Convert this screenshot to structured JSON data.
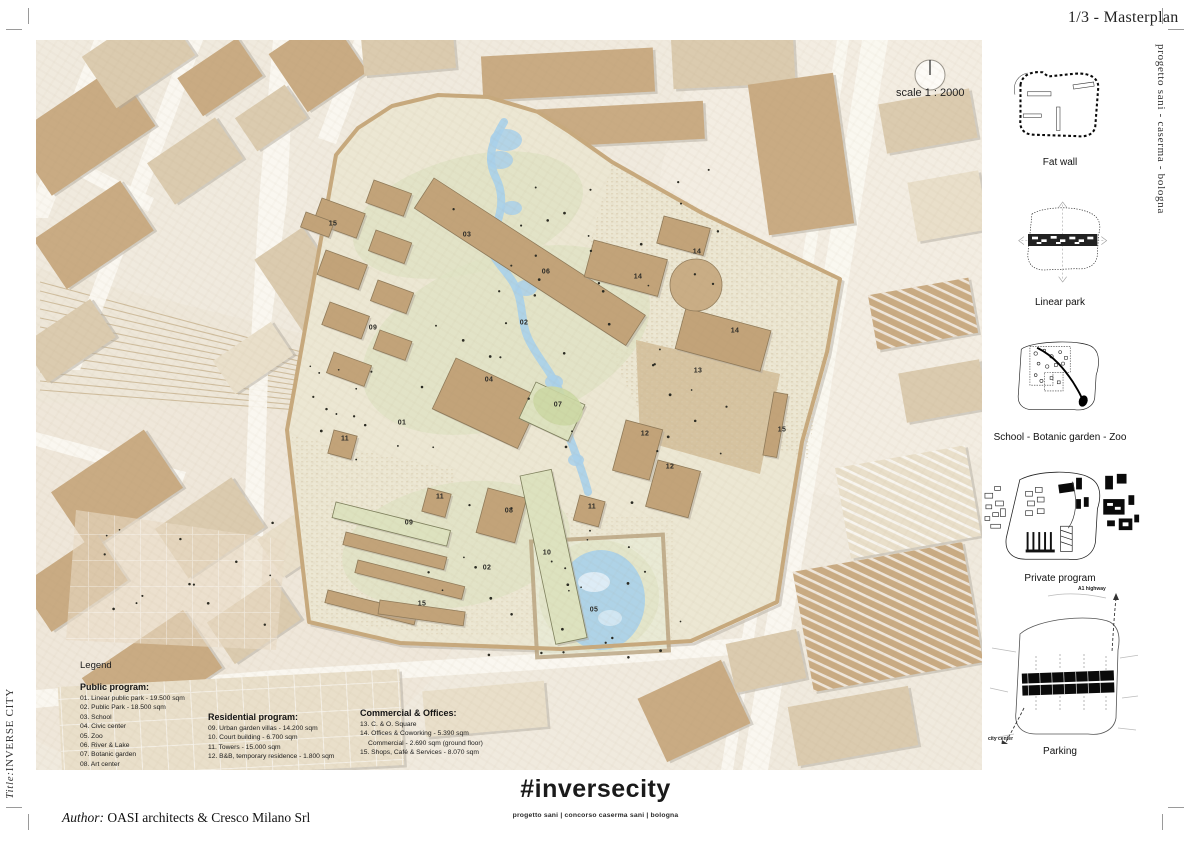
{
  "sheet": {
    "title": "1/3 - Masterplan",
    "side_text_right": "progetto sani - caserma - bologna",
    "side_text_left_label": "Title:",
    "side_text_left_value": "INVERSE CITY",
    "scale_label": "scale 1 : 2000",
    "project_title": "#inversecity",
    "footer_tags": "progetto sani   |   concorso caserma sani   |   bologna",
    "author_label": "Author:",
    "author_value": "OASI architects & Cresco Milano Srl"
  },
  "legend": {
    "title": "Legend",
    "sections": [
      {
        "heading": "Public program:",
        "items": [
          "01. Linear public park - 19.500 sqm",
          "02. Public Park - 18.500 sqm",
          "03. School",
          "04. Civic center",
          "05. Zoo",
          "06. River & Lake",
          "07. Botanic garden",
          "08. Art center"
        ]
      },
      {
        "heading": "Residential program:",
        "items": [
          "09. Urban garden villas - 14.200 sqm",
          "10. Court building - 6.700 sqm",
          "11. Towers - 15.000 sqm",
          "12. B&B, temporary residence - 1.800 sqm"
        ]
      },
      {
        "heading": "Commercial & Offices:",
        "items": [
          "13. C. & O. Square",
          "14. Offices & Coworking - 5.390 sqm",
          "Commercial - 2.690 sqm (ground floor)",
          "15. Shops, Café & Services - 8.070 sqm"
        ]
      }
    ]
  },
  "sidebar": {
    "diagrams": [
      {
        "label": "Fat wall"
      },
      {
        "label": "Linear park"
      },
      {
        "label": "School - Botanic garden - Zoo"
      },
      {
        "label": "Private program"
      },
      {
        "label": "Parking",
        "annotations": [
          "A1 highway",
          "city center"
        ]
      }
    ]
  },
  "map": {
    "number_labels": [
      {
        "n": "15",
        "x": 297,
        "y": 184
      },
      {
        "n": "03",
        "x": 431,
        "y": 195
      },
      {
        "n": "06",
        "x": 510,
        "y": 232
      },
      {
        "n": "14",
        "x": 661,
        "y": 212
      },
      {
        "n": "14",
        "x": 602,
        "y": 237
      },
      {
        "n": "14",
        "x": 699,
        "y": 291
      },
      {
        "n": "02",
        "x": 488,
        "y": 283
      },
      {
        "n": "09",
        "x": 337,
        "y": 288
      },
      {
        "n": "13",
        "x": 662,
        "y": 331
      },
      {
        "n": "04",
        "x": 453,
        "y": 340
      },
      {
        "n": "07",
        "x": 522,
        "y": 365
      },
      {
        "n": "01",
        "x": 366,
        "y": 383
      },
      {
        "n": "11",
        "x": 309,
        "y": 399
      },
      {
        "n": "12",
        "x": 609,
        "y": 394
      },
      {
        "n": "12",
        "x": 634,
        "y": 427
      },
      {
        "n": "15",
        "x": 746,
        "y": 390
      },
      {
        "n": "11",
        "x": 404,
        "y": 457
      },
      {
        "n": "08",
        "x": 473,
        "y": 471
      },
      {
        "n": "11",
        "x": 556,
        "y": 467
      },
      {
        "n": "09",
        "x": 373,
        "y": 483
      },
      {
        "n": "10",
        "x": 511,
        "y": 513
      },
      {
        "n": "02",
        "x": 451,
        "y": 528
      },
      {
        "n": "15",
        "x": 386,
        "y": 564
      },
      {
        "n": "05",
        "x": 558,
        "y": 570
      }
    ]
  },
  "colors": {
    "paper": "#f0eade",
    "building_tan": "#c9ab83",
    "site_cream": "#ece7d3",
    "park_green": "#e0e2c4",
    "water_blue": "#a9d0ea",
    "text": "#1a1a1a"
  }
}
